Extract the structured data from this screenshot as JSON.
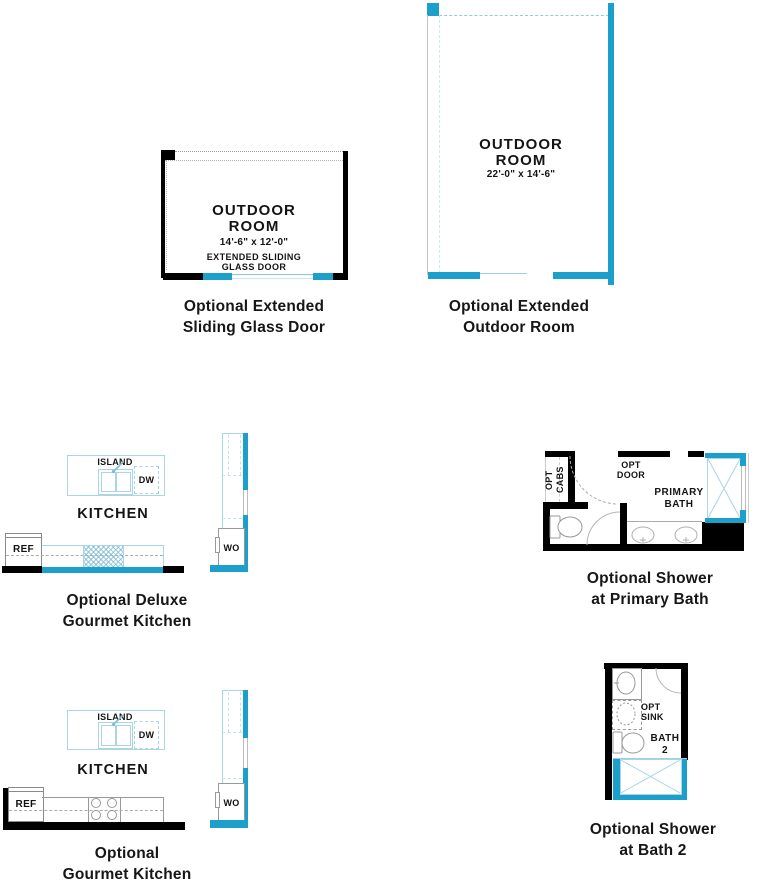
{
  "sheet_title": "Floor Plan Options",
  "colors": {
    "accent": "#1d9fcb",
    "accent_light": "#a9d5e5",
    "wall": "#000000",
    "line_gray": "#9a9a9a"
  },
  "plans": {
    "sliding_door": {
      "room": "OUTDOOR\nROOM",
      "dims": "14'-6\" x 12'-0\"",
      "feature": "EXTENDED SLIDING\nGLASS DOOR",
      "caption": "Optional Extended\nSliding Glass Door"
    },
    "outdoor_room": {
      "room": "OUTDOOR\nROOM",
      "dims": "22'-0\" x 14'-6\"",
      "caption": "Optional Extended\nOutdoor Room"
    },
    "deluxe_kitchen": {
      "room": "KITCHEN",
      "island": "ISLAND",
      "dw": "DW",
      "ref": "REF",
      "wo": "WO",
      "caption": "Optional Deluxe\nGourmet Kitchen"
    },
    "primary_bath": {
      "room": "PRIMARY\nBATH",
      "opt_cabs": "OPT\nCABS",
      "opt_door": "OPT\nDOOR",
      "caption": "Optional Shower\nat Primary Bath"
    },
    "gourmet_kitchen": {
      "room": "KITCHEN",
      "island": "ISLAND",
      "dw": "DW",
      "ref": "REF",
      "wo": "WO",
      "caption": "Optional\nGourmet Kitchen"
    },
    "bath_2": {
      "room": "BATH\n2",
      "opt_sink": "OPT\nSINK",
      "caption": "Optional Shower\nat Bath 2"
    }
  }
}
